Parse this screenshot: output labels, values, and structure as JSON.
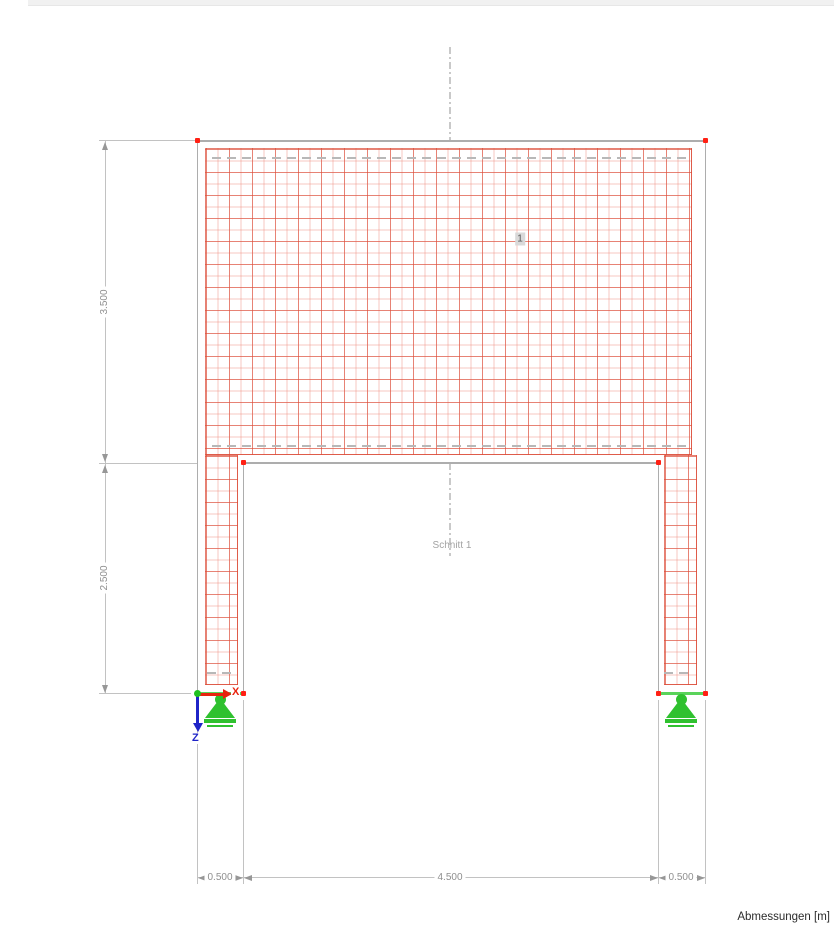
{
  "window": {
    "top_strip_present": true
  },
  "canvas": {
    "surface_label": "1",
    "section": {
      "label": "Schnitt 1"
    },
    "axes": {
      "x_label": "X",
      "z_label": "Z"
    },
    "footer_label": "Abmessungen [m]"
  },
  "dimensions": {
    "left": [
      {
        "value": "3.500"
      },
      {
        "value": "2.500"
      }
    ],
    "bottom": [
      {
        "value": "0.500"
      },
      {
        "value": "4.500"
      },
      {
        "value": "0.500"
      }
    ]
  },
  "model": {
    "shape": "portal-frame-wall-with-opening",
    "node_count_visible": 7,
    "supports": [
      "hinged-left",
      "hinged-right"
    ]
  },
  "colors": {
    "mesh_fine": "#ec8475",
    "mesh_strong": "#db4b37",
    "outline_gray": "#adadad",
    "node_red": "#ff2014",
    "origin_green": "#1fc11f",
    "support_green": "#2fc12f",
    "support_line_green": "#5ad35a",
    "axis_x_red": "#e8230f",
    "axis_z_blue": "#1f24c8",
    "dimension_gray": "#8f8f8f",
    "section_gray": "#c9c9c9"
  }
}
